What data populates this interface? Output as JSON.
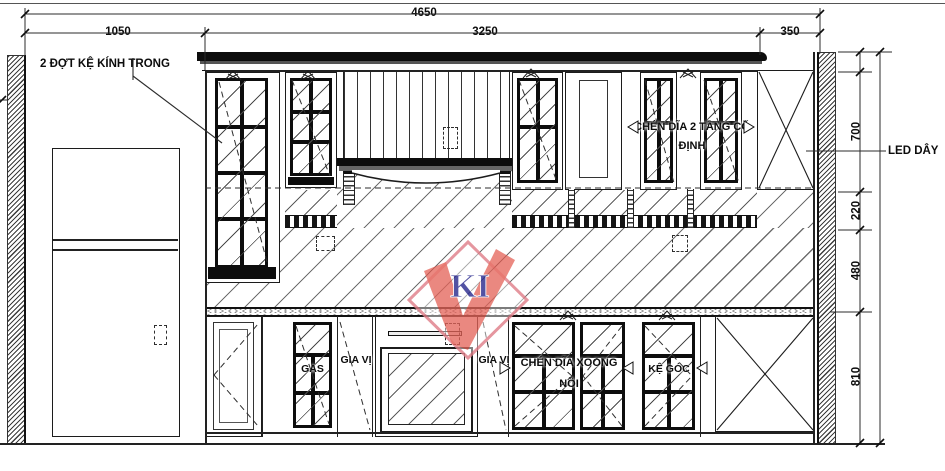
{
  "drawing": {
    "type": "kitchen-cabinet-elevation",
    "dims": {
      "total_width": "4650",
      "seg_left": "1050",
      "seg_middle": "3250",
      "seg_right": "350",
      "upper_cabinet_height": "700",
      "open_shelf_height": "220",
      "backsplash_height": "480",
      "base_cabinet_height": "810"
    },
    "labels": {
      "glass_shelf_note": "2 ĐỢT KỆ KÍNH TRONG",
      "led_note": "LED DÂY",
      "dish_upper": "CHÉN DĨA 2 TẦNG CỐ ĐỊNH",
      "gas": "GAS",
      "spice_1": "GIA VỊ",
      "spice_2": "GIA VỊ",
      "pots": "CHÉN DĨA XOONG NỒI",
      "corner_shelf": "KỆ GÓC"
    },
    "watermark": {
      "text": "KI",
      "diamond_color": "#e0808a",
      "check_color": "#e2564a",
      "text_color": "#2d2d8f"
    },
    "colors": {
      "line": "#1c1c1c",
      "hatch": "#6e6e6e"
    }
  }
}
